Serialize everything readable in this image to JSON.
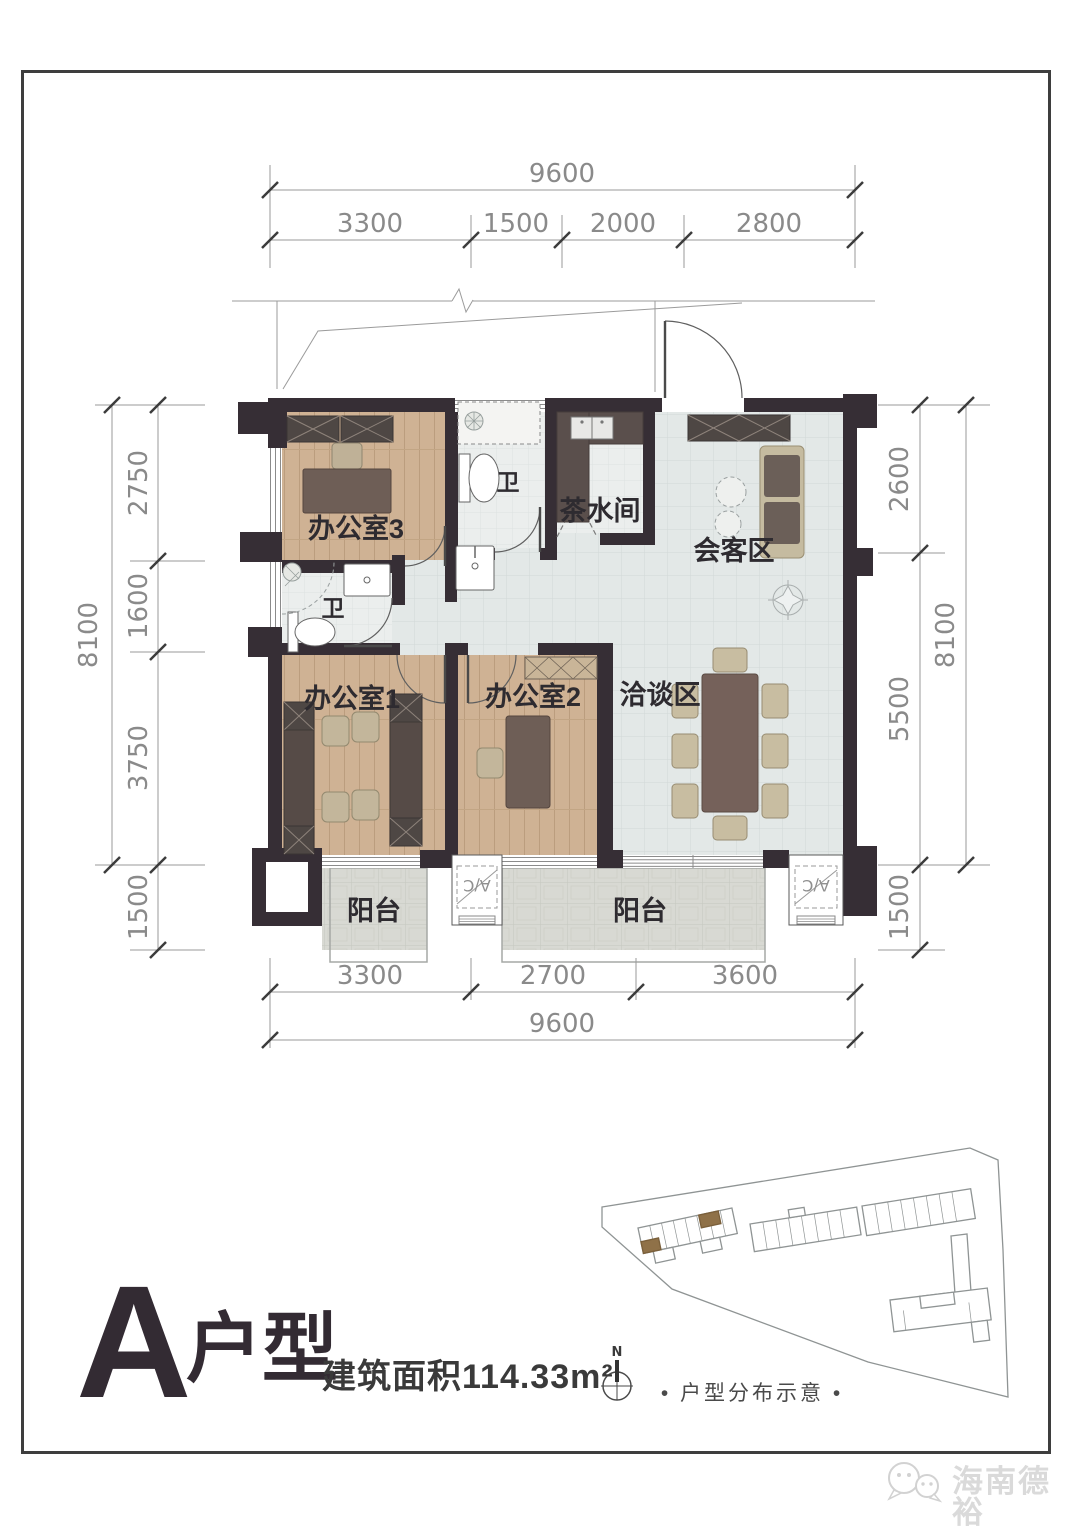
{
  "title_block": {
    "letter": "A",
    "type_label": "户型",
    "area": "建筑面积114.33m²",
    "north": "N"
  },
  "dimensions": {
    "top": {
      "total": "9600",
      "segments": [
        "3300",
        "1500",
        "2000",
        "2800"
      ]
    },
    "bottom": {
      "total": "9600",
      "segments": [
        "3300",
        "2700",
        "3600"
      ]
    },
    "left": {
      "total": "8100",
      "segments": [
        "2750",
        "1600",
        "3750"
      ],
      "balcony": "1500"
    },
    "right": {
      "total": "8100",
      "segments": [
        "2600",
        "5500"
      ],
      "balcony": "1500"
    }
  },
  "rooms": {
    "office3": "办公室3",
    "office1": "办公室1",
    "office2": "办公室2",
    "tea_room": "茶水间",
    "reception": "会客区",
    "negotiation": "洽谈区",
    "balcony_left": "阳台",
    "balcony_right": "阳台",
    "toilet_top": "卫",
    "toilet_left": "卫",
    "ac_left": "A/C",
    "ac_right": "A/C"
  },
  "site_plan": {
    "caption": "• 户型分布示意 •"
  },
  "watermark": {
    "brand": "海南德裕"
  },
  "colors": {
    "wall": "#362e35",
    "wood": "#cfb294",
    "tile": "#e3e8e7",
    "balcony_paver": "#d8d9d3",
    "furniture_dark": "#564b47",
    "sofa_beige": "#c5bba0",
    "accent_brown": "#8f7148",
    "dim_text": "#8a8a8a",
    "ink": "#332b33"
  }
}
